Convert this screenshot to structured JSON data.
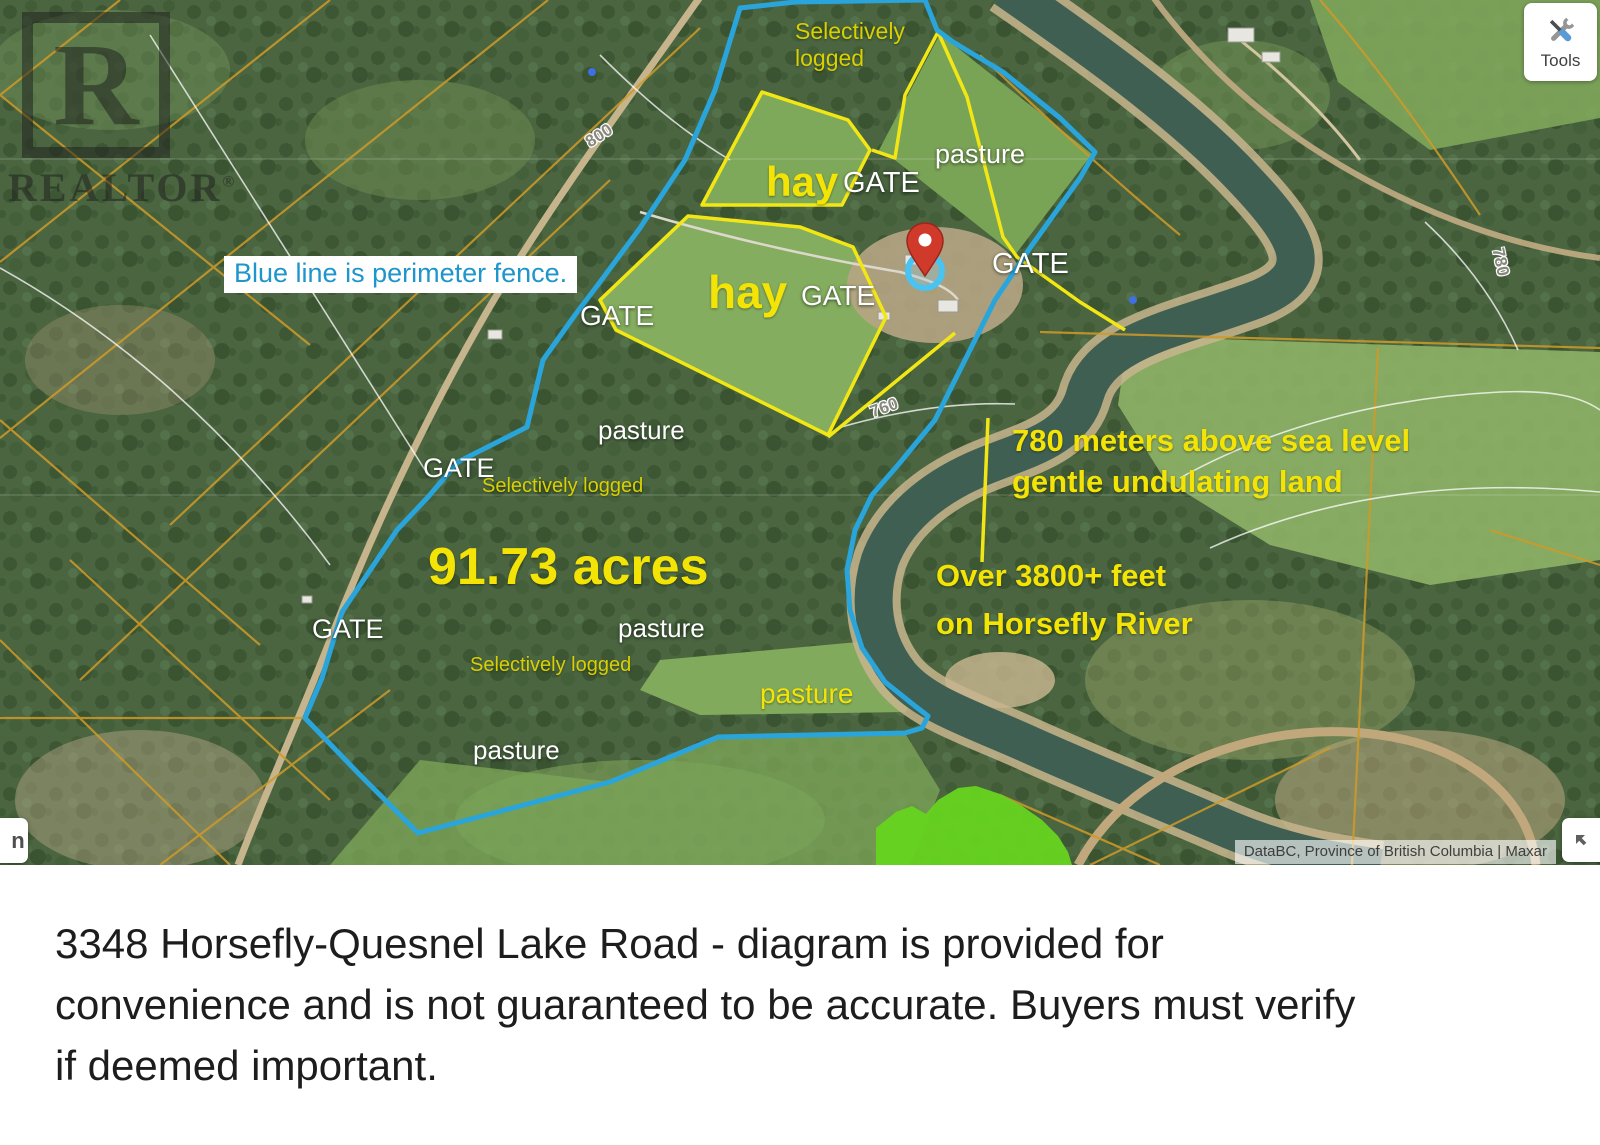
{
  "map": {
    "tools_button": {
      "label": "Tools"
    },
    "watermark": {
      "letter": "R",
      "brand": "REALTOR",
      "registered": "®"
    },
    "fence_note": "Blue line is perimeter fence.",
    "acreage": "91.73 acres",
    "labels": {
      "gate": "GATE",
      "pasture": "pasture",
      "hay": "hay",
      "selectively_logged": "Selectively logged"
    },
    "annotations": {
      "elevation_line1": "780 meters above sea level",
      "elevation_line2": "gentle undulating land",
      "river_line1": "Over 3800+ feet",
      "river_line2": "on Horsefly River"
    },
    "road_labels": {
      "r800": "800",
      "r760": "760",
      "r780": "780"
    },
    "attribution": "DataBC, Province of British Columbia | Maxar",
    "colors": {
      "fence_blue": "#2aa5dc",
      "parcel_yellow": "#f2e714",
      "annotation_yellow": "#f4e405",
      "label_olive": "#d9d002",
      "marker_red": "#cf3a2b",
      "highlight_green": "#66d41f",
      "note_blue": "#1f96cb"
    }
  },
  "caption": {
    "lines": [
      "3348 Horsefly-Quesnel Lake Road - diagram is provided for",
      "convenience and is not guaranteed to be accurate. Buyers must verify",
      "if deemed important."
    ]
  }
}
